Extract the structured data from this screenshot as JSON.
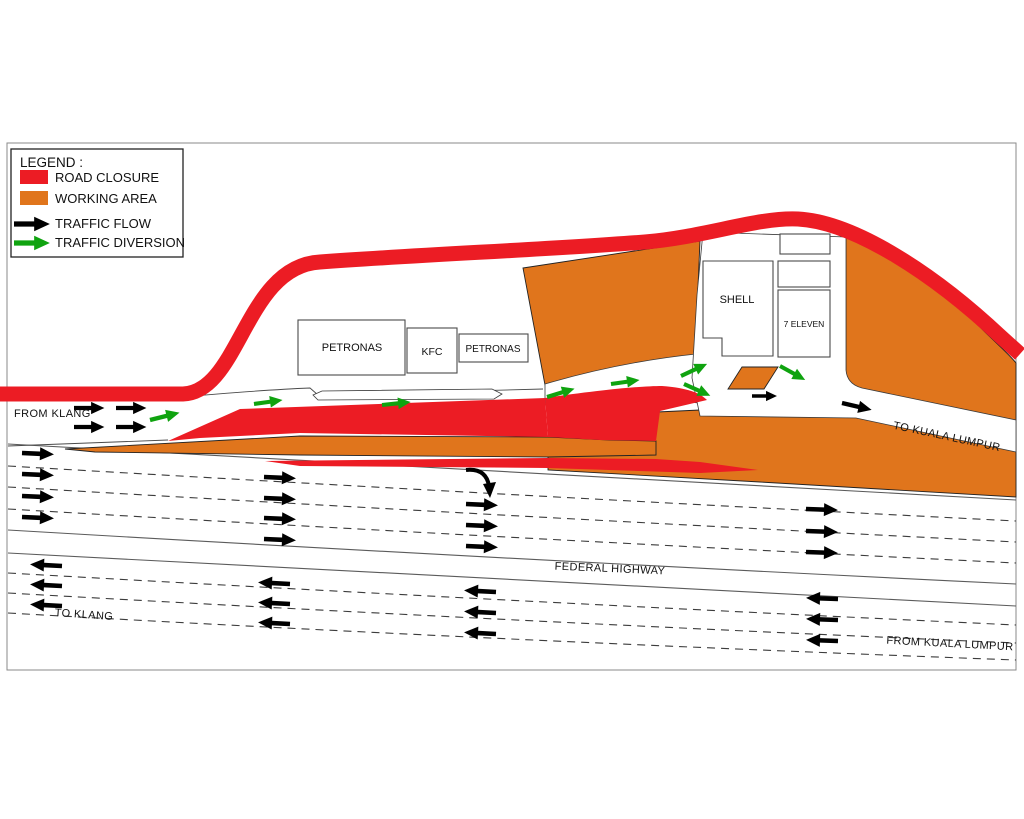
{
  "colors": {
    "road_closure": "#EC1C24",
    "working_area": "#E0751C",
    "traffic_flow": "#000000",
    "traffic_diversion": "#0FA30F"
  },
  "legend": {
    "title": "LEGEND :",
    "items": [
      {
        "label": "ROAD CLOSURE",
        "color": "#EC1C24",
        "marker": "swatch"
      },
      {
        "label": "WORKING AREA",
        "color": "#E0751C",
        "marker": "swatch"
      },
      {
        "label": "TRAFFIC FLOW",
        "color": "#000000",
        "marker": "arrow"
      },
      {
        "label": "TRAFFIC DIVERSION",
        "color": "#0FA30F",
        "marker": "arrow"
      }
    ]
  },
  "buildings": {
    "petronas_left": "PETRONAS",
    "kfc": "KFC",
    "petronas_right": "PETRONAS",
    "shell": "SHELL",
    "seven_eleven": "7 ELEVEN"
  },
  "labels": {
    "from_klang": "FROM KLANG",
    "to_kuala_lumpur": "TO KUALA LUMPUR",
    "federal_highway": "FEDERAL HIGHWAY",
    "to_klang": "TO KLANG",
    "from_kuala_lumpur": "FROM KUALA LUMPUR"
  }
}
